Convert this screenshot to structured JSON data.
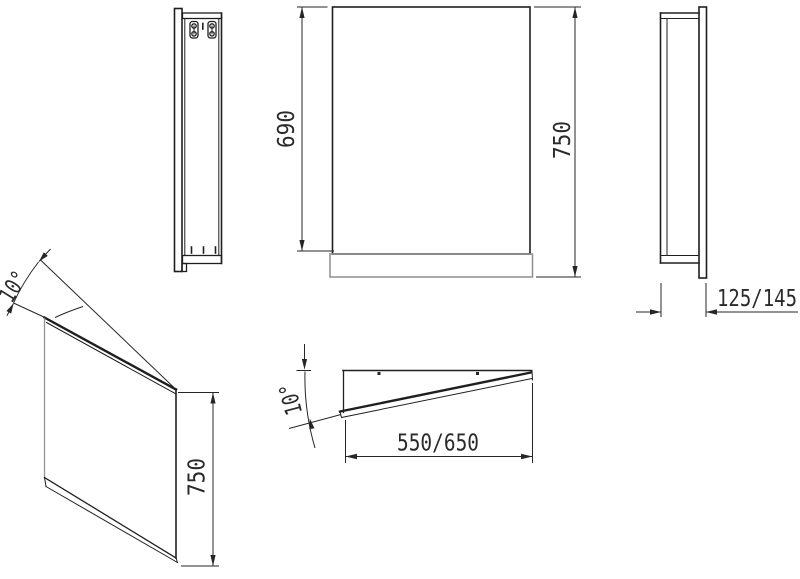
{
  "colors": {
    "line": "#1f1f1f",
    "light_line": "#8f8f8f",
    "text": "#2a2a2a",
    "background": "#ffffff"
  },
  "views": {
    "side_detail": {
      "name": "side-view-with-brackets"
    },
    "front": {
      "name": "front-view",
      "dim_mirror_height": "690",
      "dim_total_height": "750"
    },
    "side_right": {
      "name": "side-view",
      "dim_depth": "125/145"
    },
    "perspective": {
      "name": "perspective-view",
      "dim_height": "750",
      "dim_tilt_angle": "10°"
    },
    "plan": {
      "name": "top-view",
      "dim_width": "550/650",
      "dim_tilt_angle": "10°"
    }
  }
}
